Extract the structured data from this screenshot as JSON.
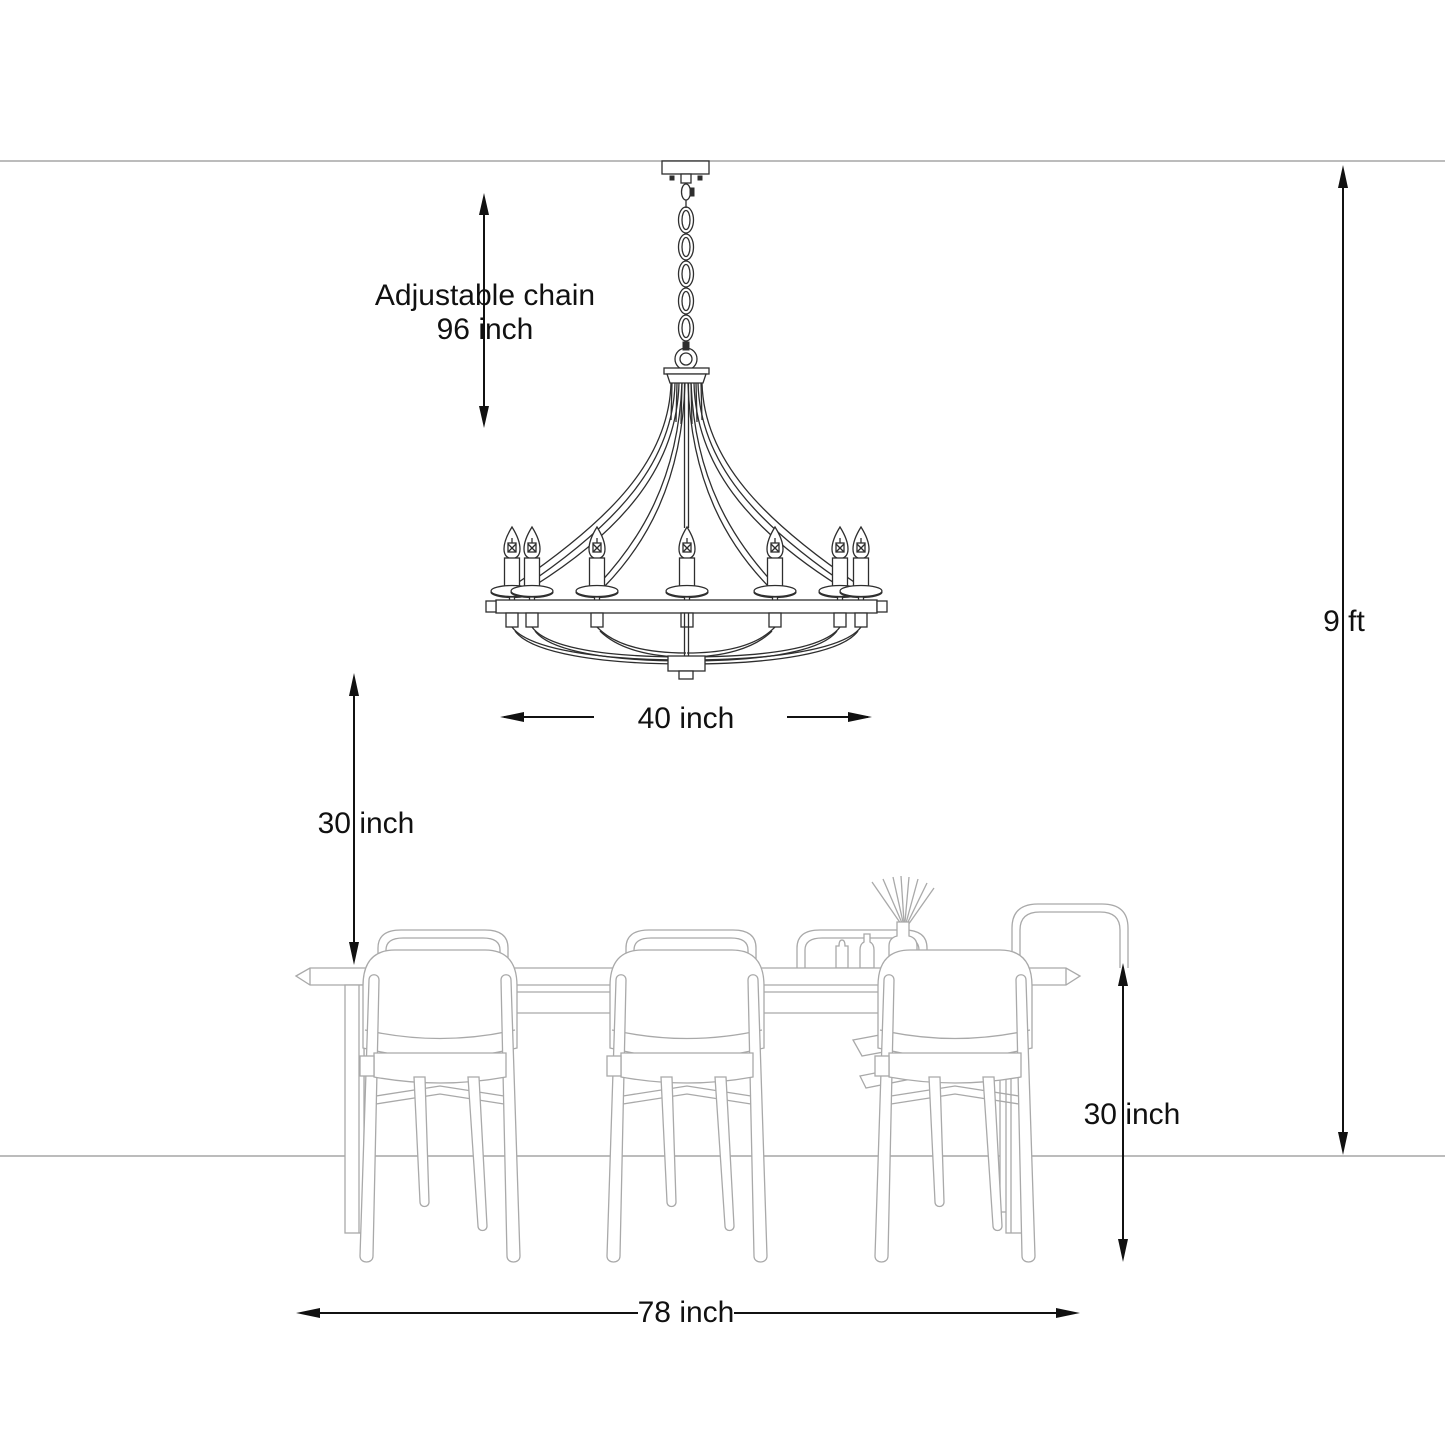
{
  "diagram": {
    "type": "product-dimension-drawing",
    "subject": "chandelier above dining table",
    "background": "#ffffff",
    "annotations": {
      "chain": {
        "line1": "Adjustable chain",
        "line2": "96 inch"
      },
      "fixture_width": "40 inch",
      "ceiling_height": "9 ft",
      "clearance_above_table": "30 inch",
      "table_height": "30 inch",
      "table_length": "78 inch",
      "text_color": "#111111"
    },
    "fixture": {
      "name": "candle chandelier",
      "visible_candle_count": 7,
      "chain_link_count": 5,
      "line_color": "#2e2e2e"
    },
    "furniture": {
      "table": {
        "name": "dining table"
      },
      "front_chair_count": 3,
      "back_chair_count": 4,
      "decor": [
        "reed diffuser with sticks",
        "small bottles"
      ],
      "line_color": "#a9a9a9"
    },
    "room": {
      "ceiling_line_color": "#b3b3b3",
      "floor_line_color": "#a9a9a9"
    }
  }
}
